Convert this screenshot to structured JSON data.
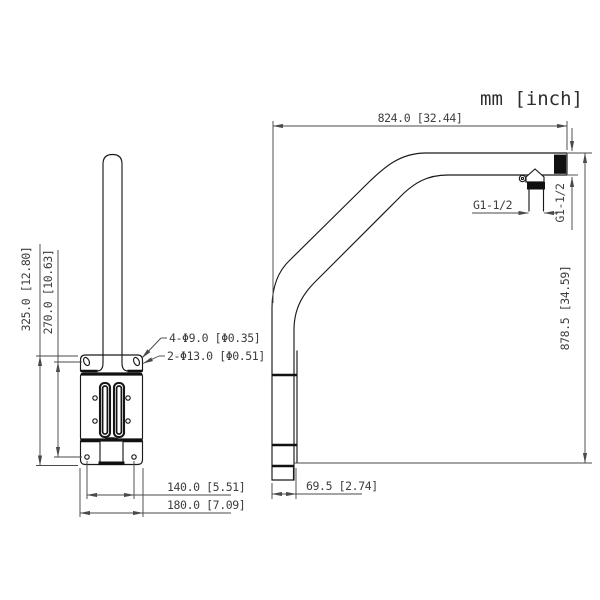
{
  "meta": {
    "units_label": "mm [inch]"
  },
  "front_view": {
    "dim_overall_height": "325.0 [12.80]",
    "dim_hole_pitch_vertical": "270.0 [10.63]",
    "callout_small_holes": "4-Φ9.0 [Φ0.35]",
    "callout_large_holes": "2-Φ13.0 [Φ0.51]",
    "dim_hole_pitch_horizontal": "140.0 [5.51]",
    "dim_overall_width": "180.0 [7.09]"
  },
  "side_view": {
    "dim_horizontal_reach": "824.0 [32.44]",
    "dim_vertical_height": "878.5 [34.59]",
    "dim_base_depth": "69.5 [2.74]",
    "thread_label_adapter": "G1-1/2",
    "thread_label_tube_end": "G1-1/2"
  },
  "colors": {
    "object_line": "#1a1a1a",
    "dimension_line": "#4a4a4a",
    "background": "#ffffff"
  }
}
